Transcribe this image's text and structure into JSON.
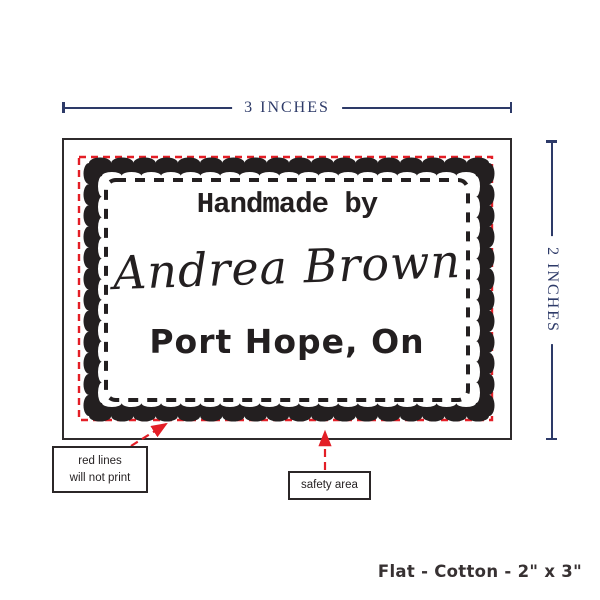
{
  "dimension_markers": {
    "width": "3 INCHES",
    "height": "2 INCHES"
  },
  "label_design": {
    "heading": "Handmade by",
    "name": "Andrea Brown",
    "location": "Port Hope, On"
  },
  "callouts": {
    "red_lines": {
      "line1": "red lines",
      "line2": "will not print"
    },
    "safety_area": "safety area"
  },
  "footer": {
    "spec": "Flat - Cotton - 2\" x 3\""
  },
  "colors": {
    "dimension_navy": "#2d3a68",
    "guide_red": "#e31e26",
    "ink_black": "#231f20",
    "border_gray": "#2f2b2c"
  }
}
